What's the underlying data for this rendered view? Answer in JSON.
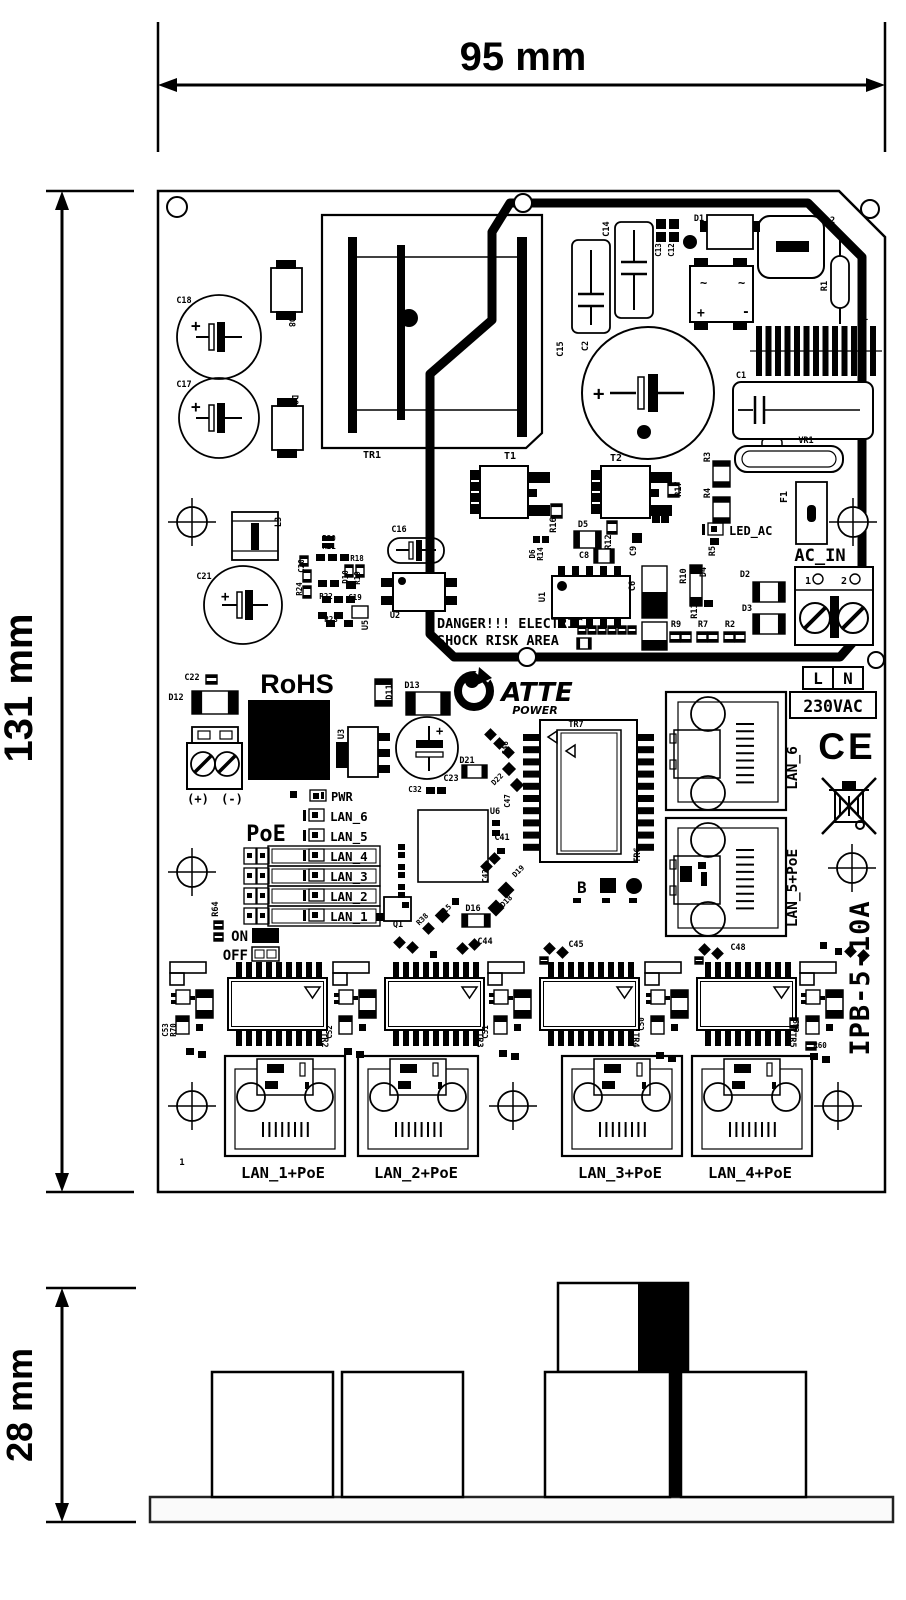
{
  "dimensions": {
    "width": "95 mm",
    "height": "131 mm",
    "side_height": "28 mm"
  },
  "silkscreen": {
    "danger_line1": "DANGER!!! ELECTRIC",
    "danger_line2": "SHOCK RISK AREA",
    "rohs": "RoHS",
    "brand": "ATTE",
    "brand_sub": "POWER",
    "model": "IPB-5-10A",
    "ac_in": "AC_IN",
    "ac_terminal_1": "1",
    "ac_terminal_2": "2",
    "line": "L",
    "neutral": "N",
    "voltage": "230VAC",
    "ce": "CE",
    "dc_plus": "(+)",
    "dc_minus": "(-)",
    "pwr": "PWR",
    "poe": "PoE",
    "on": "ON",
    "off": "OFF",
    "led_ac": "LED_AC",
    "pin1": "1",
    "bridge_ac1": "~",
    "bridge_ac2": "~",
    "bridge_plus": "+",
    "bridge_minus": "-"
  },
  "led_rows": [
    "LAN_6",
    "LAN_5",
    "LAN_4",
    "LAN_3",
    "LAN_2",
    "LAN_1"
  ],
  "ports": {
    "right": [
      "LAN_6",
      "LAN_5+PoE"
    ],
    "bottom": [
      "LAN_1+PoE",
      "LAN_2+PoE",
      "LAN_3+PoE",
      "LAN_4+PoE"
    ]
  },
  "refdes": [
    {
      "id": "C18",
      "x": 184,
      "y": 303
    },
    {
      "id": "C17",
      "x": 184,
      "y": 387
    },
    {
      "id": "D8",
      "x": 289,
      "y": 322,
      "r": 90
    },
    {
      "id": "D9",
      "x": 292,
      "y": 400,
      "r": 90
    },
    {
      "id": "TR1",
      "x": 372,
      "y": 458,
      "s": 10
    },
    {
      "id": "C15",
      "x": 563,
      "y": 349,
      "r": -90
    },
    {
      "id": "C2",
      "x": 588,
      "y": 346,
      "r": -90
    },
    {
      "id": "C14",
      "x": 609,
      "y": 229,
      "r": -90
    },
    {
      "id": "C13",
      "x": 661,
      "y": 250,
      "r": -90,
      "s": 7.5
    },
    {
      "id": "C12",
      "x": 674,
      "y": 250,
      "r": -90,
      "s": 7.5
    },
    {
      "id": "D1",
      "x": 699,
      "y": 221
    },
    {
      "id": "L2",
      "x": 830,
      "y": 223
    },
    {
      "id": "R1",
      "x": 827,
      "y": 286,
      "r": -90
    },
    {
      "id": "L1",
      "x": 863,
      "y": 320
    },
    {
      "id": "C1",
      "x": 741,
      "y": 378
    },
    {
      "id": "VR1",
      "x": 806,
      "y": 443
    },
    {
      "id": "T1",
      "x": 510,
      "y": 459,
      "s": 10
    },
    {
      "id": "T2",
      "x": 616,
      "y": 461,
      "s": 10
    },
    {
      "id": "R3",
      "x": 710,
      "y": 457,
      "r": -90
    },
    {
      "id": "R4",
      "x": 710,
      "y": 493,
      "r": -90
    },
    {
      "id": "R17",
      "x": 681,
      "y": 489,
      "r": -90
    },
    {
      "id": "R16",
      "x": 556,
      "y": 525,
      "r": -90
    },
    {
      "id": "D5",
      "x": 583,
      "y": 527
    },
    {
      "id": "D6",
      "x": 535,
      "y": 554,
      "r": -90,
      "s": 7.5
    },
    {
      "id": "R14",
      "x": 543,
      "y": 554,
      "r": -90,
      "s": 7.5
    },
    {
      "id": "C8",
      "x": 584,
      "y": 558
    },
    {
      "id": "R12",
      "x": 611,
      "y": 542,
      "r": -90
    },
    {
      "id": "C9",
      "x": 636,
      "y": 551,
      "r": -90
    },
    {
      "id": "C6",
      "x": 635,
      "y": 586,
      "r": -90
    },
    {
      "id": "U1",
      "x": 545,
      "y": 597,
      "r": -90
    },
    {
      "id": "R10",
      "x": 686,
      "y": 576,
      "r": -90
    },
    {
      "id": "D4",
      "x": 706,
      "y": 572,
      "r": -90
    },
    {
      "id": "R11",
      "x": 697,
      "y": 611,
      "r": -90
    },
    {
      "id": "R5",
      "x": 715,
      "y": 551,
      "r": -90
    },
    {
      "id": "R9",
      "x": 676,
      "y": 627
    },
    {
      "id": "R7",
      "x": 703,
      "y": 627
    },
    {
      "id": "R2",
      "x": 730,
      "y": 627
    },
    {
      "id": "D2",
      "x": 745,
      "y": 577
    },
    {
      "id": "D3",
      "x": 747,
      "y": 611
    },
    {
      "id": "F1",
      "x": 787,
      "y": 497,
      "r": -90,
      "s": 10
    },
    {
      "id": "L3",
      "x": 281,
      "y": 522,
      "r": -90
    },
    {
      "id": "C21",
      "x": 204,
      "y": 579
    },
    {
      "id": "C16",
      "x": 399,
      "y": 532
    },
    {
      "id": "U2",
      "x": 395,
      "y": 618
    },
    {
      "id": "R20",
      "x": 329,
      "y": 541,
      "s": 7.5
    },
    {
      "id": "R21",
      "x": 329,
      "y": 549,
      "s": 7.5
    },
    {
      "id": "C20",
      "x": 304,
      "y": 566,
      "r": -90,
      "s": 7.5
    },
    {
      "id": "R24",
      "x": 302,
      "y": 589,
      "r": -90,
      "s": 7.5
    },
    {
      "id": "R22",
      "x": 326,
      "y": 599,
      "s": 7.5
    },
    {
      "id": "R18",
      "x": 357,
      "y": 561,
      "s": 7.5
    },
    {
      "id": "D10",
      "x": 348,
      "y": 577,
      "r": -90,
      "s": 7.5
    },
    {
      "id": "R19",
      "x": 360,
      "y": 578,
      "r": -90,
      "s": 7.5
    },
    {
      "id": "C19",
      "x": 355,
      "y": 600,
      "s": 7.5
    },
    {
      "id": "R23",
      "x": 331,
      "y": 622,
      "s": 7.5
    },
    {
      "id": "U5",
      "x": 368,
      "y": 625,
      "r": -90
    },
    {
      "id": "C22",
      "x": 192,
      "y": 680
    },
    {
      "id": "D12",
      "x": 176,
      "y": 700
    },
    {
      "id": "D11",
      "x": 392,
      "y": 692,
      "r": -90
    },
    {
      "id": "D13",
      "x": 412,
      "y": 688
    },
    {
      "id": "C23",
      "x": 451,
      "y": 781
    },
    {
      "id": "U3",
      "x": 344,
      "y": 734,
      "r": -90
    },
    {
      "id": "D21",
      "x": 467,
      "y": 763
    },
    {
      "id": "C32",
      "x": 415,
      "y": 792,
      "s": 7.5
    },
    {
      "id": "C47",
      "x": 510,
      "y": 801,
      "r": -90,
      "s": 7.5
    },
    {
      "id": "D22",
      "x": 499,
      "y": 781,
      "r": -45,
      "s": 7.5
    },
    {
      "id": "C46",
      "x": 508,
      "y": 748,
      "r": -90,
      "s": 7.5
    },
    {
      "id": "U6",
      "x": 495,
      "y": 814
    },
    {
      "id": "C41",
      "x": 502,
      "y": 840
    },
    {
      "id": "C43",
      "x": 488,
      "y": 876,
      "r": -90,
      "s": 7.5
    },
    {
      "id": "TR7",
      "x": 576,
      "y": 727
    },
    {
      "id": "TR6",
      "x": 640,
      "y": 855,
      "r": -90
    },
    {
      "id": "R64",
      "x": 218,
      "y": 909,
      "r": -90
    },
    {
      "id": "Q1",
      "x": 398,
      "y": 927
    },
    {
      "id": "R38",
      "x": 424,
      "y": 921,
      "r": -45,
      "s": 7.5
    },
    {
      "id": "D15",
      "x": 447,
      "y": 912,
      "r": -45,
      "s": 7.5
    },
    {
      "id": "D16",
      "x": 473,
      "y": 911
    },
    {
      "id": "D18",
      "x": 508,
      "y": 903,
      "r": -45,
      "s": 7.5
    },
    {
      "id": "D19",
      "x": 520,
      "y": 873,
      "r": -45,
      "s": 7.5
    },
    {
      "id": "C44",
      "x": 485,
      "y": 944
    },
    {
      "id": "C45",
      "x": 576,
      "y": 947
    },
    {
      "id": "C48",
      "x": 738,
      "y": 950
    },
    {
      "id": "TR2",
      "x": 322,
      "y": 1040,
      "r": 90
    },
    {
      "id": "TR3",
      "x": 477,
      "y": 1040,
      "r": 90
    },
    {
      "id": "TR4",
      "x": 633,
      "y": 1040,
      "r": 90
    },
    {
      "id": "TR5",
      "x": 790,
      "y": 1040,
      "r": 90
    },
    {
      "id": "C53",
      "x": 168,
      "y": 1030,
      "r": -90,
      "s": 7.5
    },
    {
      "id": "R70",
      "x": 176,
      "y": 1030,
      "r": -90,
      "s": 7.5
    },
    {
      "id": "C52",
      "x": 332,
      "y": 1032,
      "r": -90,
      "s": 7.5
    },
    {
      "id": "C51",
      "x": 488,
      "y": 1032,
      "r": -90,
      "s": 7.5
    },
    {
      "id": "C50",
      "x": 644,
      "y": 1024,
      "r": -90,
      "s": 7.5
    },
    {
      "id": "C49",
      "x": 799,
      "y": 1026,
      "r": -90,
      "s": 7.5
    },
    {
      "id": "R60",
      "x": 820,
      "y": 1048,
      "s": 7.5
    }
  ]
}
